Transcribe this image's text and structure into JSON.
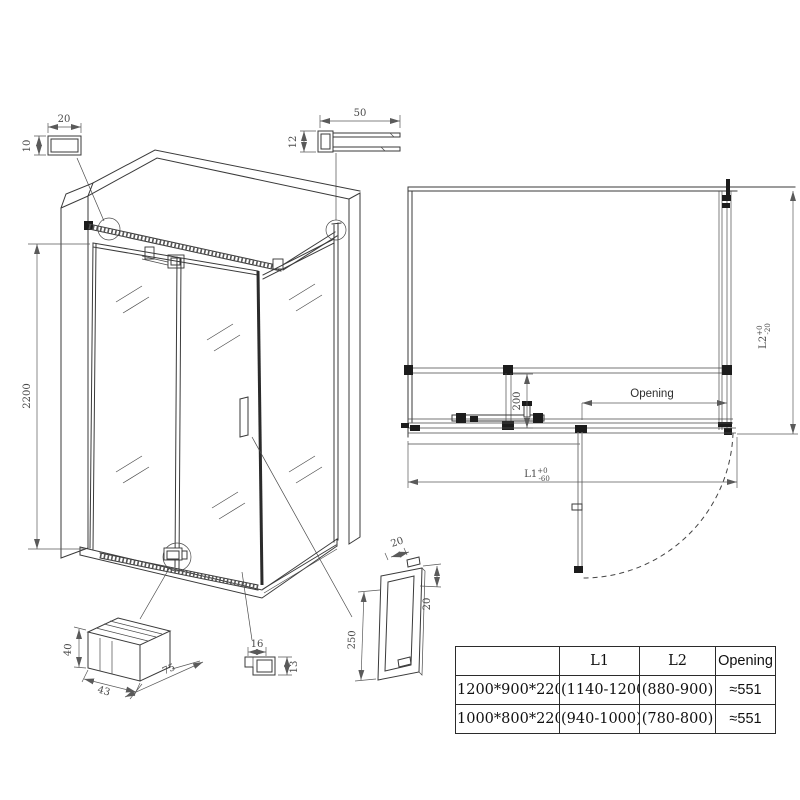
{
  "colors": {
    "line": "#3a3a3a",
    "dim_text": "#4a4a4a",
    "background": "#ffffff"
  },
  "details": {
    "tube_section": {
      "width_label": "20",
      "height_label": "10"
    },
    "channel_profile": {
      "width_label": "50",
      "height_label": "12"
    },
    "iso_view": {
      "height_label": "2200"
    },
    "plan_view": {
      "support_offset_label": "200",
      "opening_label": "Opening",
      "l1_label": "L1",
      "l1_tol_plus": "+0",
      "l1_tol_minus": "-60",
      "l2_label": "L2",
      "l2_tol_plus": "+0",
      "l2_tol_minus": "-20"
    },
    "wall_bracket": {
      "height_label": "40",
      "depth_label": "43",
      "length_label": "75"
    },
    "bottom_profile": {
      "width_label": "16",
      "height_label": "13"
    },
    "handle": {
      "tube_label": "20",
      "offset_label": "20",
      "length_label": "250"
    }
  },
  "table": {
    "headers": [
      "",
      "L1",
      "L2",
      "Opening"
    ],
    "rows": [
      [
        "1200*900*2200",
        "(1140-1200)",
        "(880-900)",
        "≈551"
      ],
      [
        "1000*800*2200",
        "(940-1000)",
        "(780-800)",
        "≈551"
      ]
    ]
  }
}
